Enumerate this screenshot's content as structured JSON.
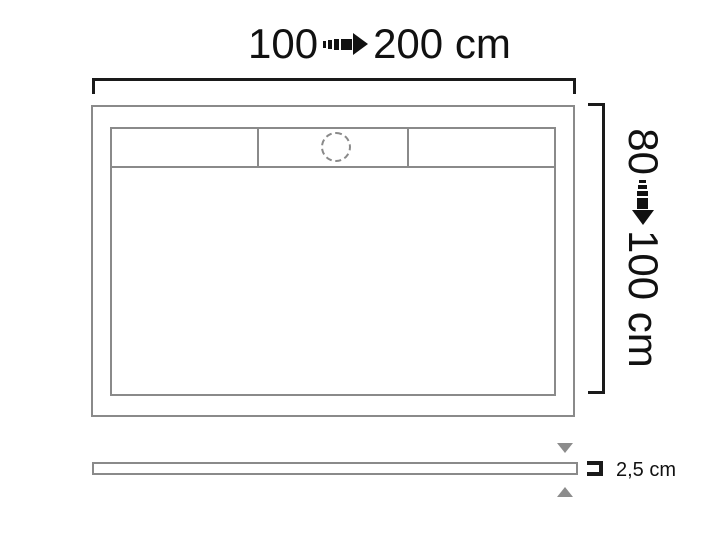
{
  "diagram": {
    "width_dimension": {
      "from": "100",
      "to": "200 cm"
    },
    "depth_dimension": {
      "from": "80",
      "to": "100 cm"
    },
    "thickness_dimension": {
      "label": "2,5 cm"
    },
    "icons": {
      "width_arrow": "dashed-arrow-right-icon",
      "depth_arrow": "dashed-arrow-down-icon",
      "thickness_top_arrow": "triangle-down-icon",
      "thickness_bottom_arrow": "triangle-up-icon",
      "thickness_bracket": "thickness-bracket-icon",
      "drain": "drain-circle-icon"
    },
    "colors": {
      "outline_gray": "#8a8a8a",
      "dimension_black": "#1a1a1a",
      "arrow_gray": "#8c8c8c",
      "background": "#ffffff"
    }
  }
}
